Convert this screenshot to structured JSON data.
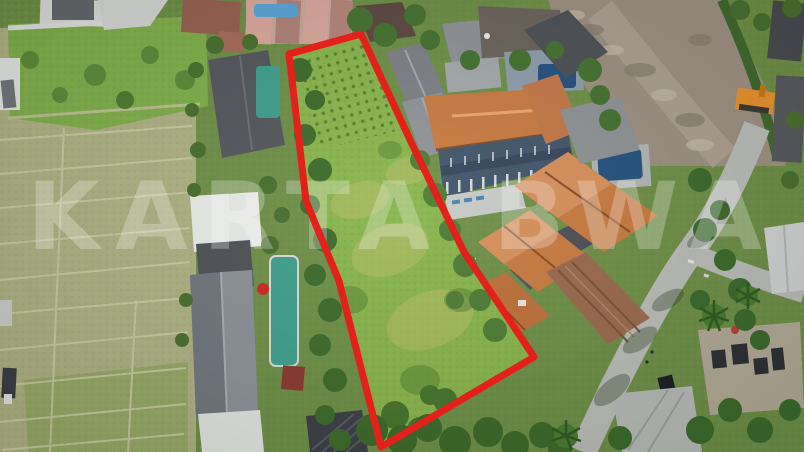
{
  "image": {
    "type": "aerial-drone-photograph",
    "subject": "Land plot for sale outlined in red, surrounded by villas, swimming pools, rice fields, trees and a village road",
    "watermark": "KARTA BWA"
  },
  "palette": {
    "plot_outline": "#e4201a",
    "plot_grass": "#88b44c",
    "rice_field": "#aeb183",
    "orange_roof": "#c87b41",
    "grey_roof": "#5a5f66",
    "pool_teal": "#3f9f8d",
    "pool_navy": "#24527f",
    "road": "#b9bcb7",
    "dirt": "#9c9081",
    "watermark_color": "rgba(255,255,255,0.26)"
  }
}
